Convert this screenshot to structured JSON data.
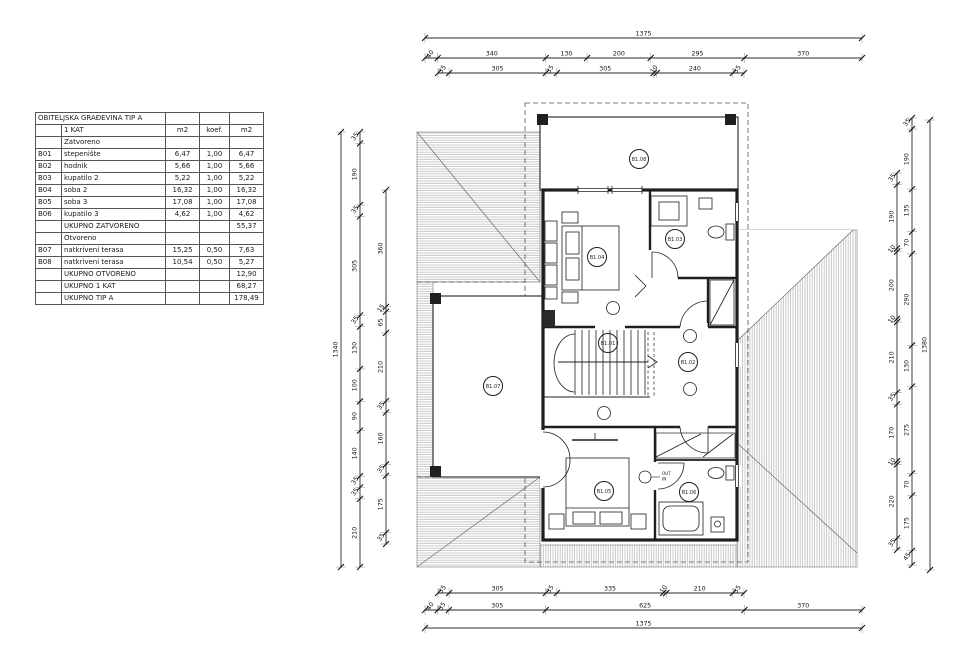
{
  "colors": {
    "background": "#ffffff",
    "line": "#1f1f1f",
    "hatch": "#9c9c9c",
    "dim": "#2a2a2a"
  },
  "table": {
    "title": "OBITELJSKA GRAĐEVINA TIP A",
    "rows": [
      [
        "",
        "1 KAT",
        "m2",
        "koef.",
        "m2"
      ],
      [
        "",
        "Zatvoreno",
        "",
        "",
        ""
      ],
      [
        "B01",
        "stepenište",
        "6,47",
        "1,00",
        "6,47"
      ],
      [
        "B02",
        "hodnik",
        "5,66",
        "1,00",
        "5,66"
      ],
      [
        "B03",
        "kupatilo 2",
        "5,22",
        "1,00",
        "5,22"
      ],
      [
        "B04",
        "soba 2",
        "16,32",
        "1,00",
        "16,32"
      ],
      [
        "B05",
        "soba 3",
        "17,08",
        "1,00",
        "17,08"
      ],
      [
        "B06",
        "kupatilo 3",
        "4,62",
        "1,00",
        "4,62"
      ],
      [
        "",
        "UKUPNO ZATVORENO",
        "",
        "",
        "55,37"
      ],
      [
        "",
        "Otvoreno",
        "",
        "",
        ""
      ],
      [
        "B07",
        "natkriveni terasa",
        "15,25",
        "0,50",
        "7,63"
      ],
      [
        "B08",
        "natkriveni terasa",
        "10,54",
        "0,50",
        "5,27"
      ],
      [
        "",
        "UKUPNO OTVORENO",
        "",
        "",
        "12,90"
      ],
      [
        "",
        "UKUPNO 1 KAT",
        "",
        "",
        "68,27"
      ],
      [
        "",
        "UKUPNO TIP A",
        "",
        "",
        "178,49"
      ]
    ]
  },
  "plan": {
    "rooms": [
      {
        "id": "B1.01"
      },
      {
        "id": "B1.02"
      },
      {
        "id": "B1.03"
      },
      {
        "id": "B1.04"
      },
      {
        "id": "B1.05"
      },
      {
        "id": "B1.06"
      },
      {
        "id": "B1.07"
      },
      {
        "id": "B1.08"
      }
    ],
    "out_label": "OUT",
    "in_label": "IN"
  },
  "dims": {
    "top": [
      [
        "1375"
      ],
      [
        "40",
        "340",
        "130",
        "200",
        "295",
        "370"
      ],
      [
        "35",
        "305",
        "35",
        "305",
        "10",
        "240",
        "35"
      ]
    ],
    "bottom": [
      [
        "35",
        "305",
        "35",
        "335",
        "10",
        "210",
        "35"
      ],
      [
        "40",
        "35",
        "305",
        "625",
        "370"
      ],
      [
        "1375"
      ]
    ],
    "left": [
      [
        "1340"
      ],
      [
        "35",
        "190",
        "35",
        "305",
        "35",
        "130",
        "100",
        "90",
        "140",
        "35",
        "35",
        "210"
      ],
      [
        "360",
        "15",
        "65",
        "210",
        "35",
        "160",
        "35",
        "175",
        "35"
      ]
    ],
    "right": [
      [
        "35",
        "190",
        "10",
        "200",
        "10",
        "210",
        "35",
        "170",
        "10",
        "220",
        "35"
      ],
      [
        "35",
        "190",
        "135",
        "70",
        "290",
        "130",
        "275",
        "70",
        "175",
        "45"
      ],
      [
        "1380"
      ]
    ]
  }
}
